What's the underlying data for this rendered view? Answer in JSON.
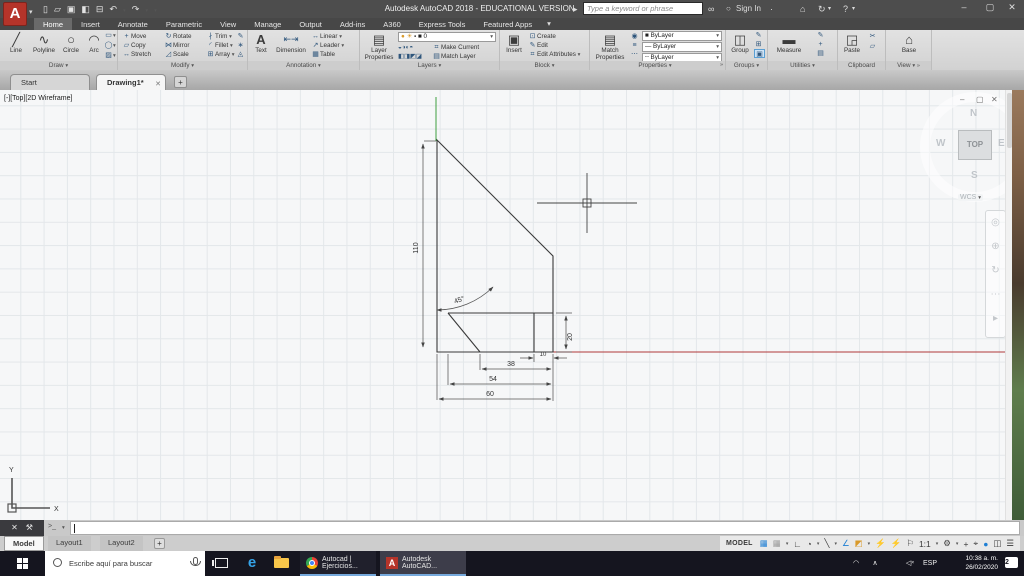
{
  "window": {
    "title": "Autodesk AutoCAD 2018 - EDUCATIONAL VERSION",
    "doc": "Drawing1.dwg"
  },
  "titlebar": {
    "search_placeholder": "Type a keyword or phrase",
    "sign_in": "Sign In"
  },
  "ribbon": {
    "tabs": [
      "Home",
      "Insert",
      "Annotate",
      "Parametric",
      "View",
      "Manage",
      "Output",
      "Add-ins",
      "A360",
      "Express Tools",
      "Featured Apps"
    ],
    "draw": {
      "label": "Draw",
      "buttons": [
        "Line",
        "Polyline",
        "Circle",
        "Arc"
      ]
    },
    "modify": {
      "label": "Modify",
      "buttons": [
        "Move",
        "Rotate",
        "Trim",
        "Copy",
        "Mirror",
        "Fillet",
        "Stretch",
        "Scale",
        "Array"
      ]
    },
    "annotation": {
      "label": "Annotation",
      "big": [
        "Text",
        "Dimension"
      ],
      "stack": [
        "Linear",
        "Leader",
        "Table"
      ]
    },
    "layers": {
      "label": "Layers",
      "big": "Layer Properties",
      "current": "0",
      "make_current": "Make Current",
      "match_layer": "Match Layer",
      "row1_icons": "◒◑◐◓",
      "row2_icons": "◧◨◩◪"
    },
    "block": {
      "label": "Block",
      "big": "Insert",
      "stack": [
        "Create",
        "Edit",
        "Edit Attributes"
      ]
    },
    "properties": {
      "label": "Properties",
      "big": "Match Properties",
      "color": "ByLayer",
      "lineweight": "ByLayer",
      "linetype": "ByLayer"
    },
    "groups": {
      "label": "Groups",
      "big": "Group"
    },
    "utilities": {
      "label": "Utilities",
      "big": "Measure"
    },
    "clipboard": {
      "label": "Clipboard",
      "big": "Paste"
    },
    "view": {
      "label": "View",
      "big": "Base"
    }
  },
  "file_tabs": {
    "start": "Start",
    "drawing": "Drawing1*"
  },
  "canvas": {
    "viewport_label": "[-][Top][2D Wireframe]",
    "viewcube": {
      "n": "N",
      "w": "W",
      "e": "E",
      "s": "S",
      "top": "TOP",
      "wcs": "WCS"
    },
    "dims": {
      "height": "110",
      "angle": "45°",
      "step": "20",
      "w10": "10",
      "w38": "38",
      "w54": "54",
      "w60": "60"
    },
    "axis": {
      "x": "X",
      "y": "Y"
    }
  },
  "command": {
    "prompt": ">_"
  },
  "layout_tabs": [
    "Model",
    "Layout1",
    "Layout2"
  ],
  "status": {
    "model": "MODEL",
    "scale": "1:1"
  },
  "taskbar": {
    "search_placeholder": "Escribe aquí para buscar",
    "chrome_label": "Autocad | Ejercicios...",
    "autocad_label": "Autodesk AutoCAD...",
    "lang": "ESP",
    "time": "10:38 a. m.",
    "date": "26/02/2020",
    "badge": "2",
    "edge": "e"
  },
  "icons": {
    "caret": "▾",
    "chev_right": "»",
    "close": "✕",
    "minimize": "–",
    "restore": "▢",
    "new": "▯",
    "open": "▱",
    "save": "▣",
    "saveas": "◧",
    "plot": "⊟",
    "undo": "↶",
    "redo": "↷",
    "flyout": "▸",
    "binoculars": "∞",
    "store": "⌂",
    "exchange": "↻",
    "help": "?",
    "line": "╱",
    "polyline": "∿",
    "circle": "○",
    "arc": "◠",
    "rect": "▭",
    "ellipse": "◯",
    "hatch": "▨",
    "move": "+",
    "rotate": "↻",
    "trim": "∤",
    "copy": "▱",
    "mirror": "⋈",
    "fillet": "◜",
    "stretch": "↔",
    "scale": "◿",
    "array": "⊞",
    "erase": "✎",
    "explode": "∗",
    "offset": "◬",
    "text": "A",
    "dim": "⇤⇥",
    "linear": "↔",
    "leader": "↗",
    "table": "▦",
    "layers_big": "▤",
    "bulb": "●",
    "sun": "☀",
    "lock": "▪",
    "swatch": "■",
    "insert": "▣",
    "create": "⊡",
    "edit": "✎",
    "editattr": "⌗",
    "matchprops": "▤",
    "colwheel": "◉",
    "lines": "≡",
    "dots": "⋯",
    "lwt": "—",
    "ltype": "┄",
    "group": "◫",
    "g1": "✎",
    "g2": "⊞",
    "g3": "▣",
    "measure": "▬",
    "u1": "✎",
    "u2": "+",
    "u3": "▤",
    "paste": "◲",
    "cut": "✂",
    "copy2": "▱",
    "base": "⌂",
    "grid": "▦",
    "snap": "▦",
    "ortho": "∟",
    "polar": "◔",
    "otrack": "╲",
    "iso": "∠",
    "dyn": "◩",
    "run1": "⚡",
    "run2": "⚡",
    "flag": "⚐",
    "gear": "⚙",
    "plus": "+",
    "target": "⌖",
    "dot": "●",
    "monitor": "◫",
    "burger": "☰",
    "cmd_tools": "⚒",
    "nav1": "◎",
    "nav2": "⊕",
    "nav3": "↻",
    "nav4": "⋯",
    "nav5": "▸",
    "chev_up": "∧",
    "spk": "◁",
    "spk_x": "×",
    "people": "◠"
  },
  "colors": {
    "accent_blue": "#1f7fd4",
    "autocad_red": "#b5342a",
    "construction_red": "#b03a3a",
    "construction_green": "#3f9f3f",
    "taskbar": "#15151f"
  }
}
